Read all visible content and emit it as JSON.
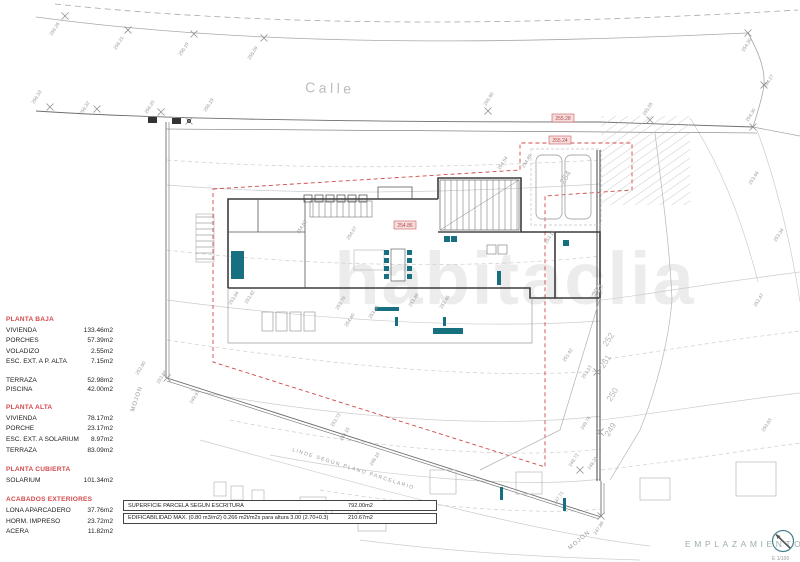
{
  "street": {
    "name": "Calle"
  },
  "watermark": {
    "text": "habitaclia"
  },
  "surface_schedule": {
    "sections": [
      {
        "title": "PLANTA BAJA",
        "compact": false,
        "rows": [
          {
            "label": "VIVIENDA",
            "value": "133.46m2"
          },
          {
            "label": "PORCHES",
            "value": "57.39m2"
          },
          {
            "label": "VOLADIZO",
            "value": "2.55m2"
          },
          {
            "label": "ESC. EXT. A P. ALTA",
            "value": "7.15m2"
          }
        ]
      },
      {
        "title": "",
        "compact": true,
        "rows": [
          {
            "label": "TERRAZA",
            "value": "52.98m2"
          },
          {
            "label": "PISCINA",
            "value": "42.00m2"
          }
        ]
      },
      {
        "title": "PLANTA ALTA",
        "compact": false,
        "rows": [
          {
            "label": "VIVIENDA",
            "value": "78.17m2"
          },
          {
            "label": "PORCHE",
            "value": "23.17m2"
          },
          {
            "label": "ESC. EXT. A SOLARIUM",
            "value": "8.97m2"
          },
          {
            "label": "TERRAZA",
            "value": "83.09m2"
          }
        ]
      },
      {
        "title": "PLANTA CUBIERTA",
        "compact": false,
        "rows": [
          {
            "label": "SOLARIUM",
            "value": "101.34m2"
          }
        ]
      },
      {
        "title": "ACABADOS EXTERIORES",
        "compact": false,
        "rows": [
          {
            "label": "LONA APARCADERO",
            "value": "37.76m2"
          },
          {
            "label": "HORM. IMPRESO",
            "value": "23.72m2"
          },
          {
            "label": "ACERA",
            "value": "11.82m2"
          }
        ]
      }
    ]
  },
  "summary_table": {
    "rows": [
      {
        "label": "SUPERFICIE PARCELA SEGÚN  ESCRITURA",
        "value": "792.00m2"
      },
      {
        "label": "EDIFICABILIDAD MÁX. (0.80 m3/m2)   0.266 m2t/m2s para altura 3.00 (2.70+0.3)",
        "value": "210.67m2"
      }
    ]
  },
  "title_block": {
    "title": "EMPLAZAMIENTO",
    "scale": "E 1/100",
    "icon": "compass-icon"
  },
  "boundary": {
    "linde_label": "LINDE SEGÚN PLANO PARCELARIO",
    "mojon_label_left": "MOJON",
    "mojon_label_right": "MOJON"
  },
  "levels": {
    "red_boxed": [
      [
        "255.28",
        552,
        114
      ],
      [
        "255.24",
        549,
        136
      ],
      [
        "254.86",
        394,
        221
      ]
    ],
    "spot": [
      [
        "256.26",
        52,
        36
      ],
      [
        "256.21",
        116,
        50
      ],
      [
        "256.19",
        181,
        56
      ],
      [
        "256.09",
        250,
        60
      ],
      [
        "254.30",
        744,
        52
      ],
      [
        "254.27",
        766,
        88
      ],
      [
        "256.33",
        34,
        104
      ],
      [
        "256.32",
        82,
        115
      ],
      [
        "256.20",
        147,
        114
      ],
      [
        "256.19",
        206,
        112
      ],
      [
        "255.90",
        486,
        106
      ],
      [
        "255.05",
        645,
        116
      ],
      [
        "254.30",
        748,
        122
      ],
      [
        "254.54",
        500,
        170
      ],
      [
        "254.49",
        524,
        168
      ],
      [
        "254.62",
        299,
        234
      ],
      [
        "254.07",
        349,
        240
      ],
      [
        "254.40",
        347,
        327
      ],
      [
        "253.84",
        231,
        305
      ],
      [
        "253.42",
        247,
        304
      ],
      [
        "253.79",
        338,
        310
      ],
      [
        "253.66",
        371,
        319
      ],
      [
        "253.49",
        411,
        307
      ],
      [
        "253.45",
        442,
        309
      ],
      [
        "253.73",
        333,
        427
      ],
      [
        "253.16",
        547,
        244
      ],
      [
        "253.08",
        159,
        384
      ],
      [
        "252.60",
        138,
        375
      ],
      [
        "249.97",
        192,
        404
      ],
      [
        "248.15",
        342,
        441
      ],
      [
        "248.18",
        372,
        466
      ],
      [
        "247.71",
        556,
        505
      ],
      [
        "247.88",
        596,
        535
      ],
      [
        "251.42",
        565,
        362
      ],
      [
        "251.13",
        584,
        379
      ],
      [
        "249.76",
        583,
        430
      ],
      [
        "248.72",
        571,
        467
      ],
      [
        "248.31",
        590,
        470
      ],
      [
        "253.44",
        751,
        185
      ],
      [
        "253.34",
        776,
        242
      ],
      [
        "252.47",
        756,
        307
      ],
      [
        "250.63",
        764,
        432
      ]
    ],
    "contours": [
      [
        "254",
        564,
        185
      ],
      [
        "253",
        596,
        298
      ],
      [
        "252",
        607,
        347
      ],
      [
        "251",
        604,
        369
      ],
      [
        "250",
        611,
        402
      ],
      [
        "249",
        609,
        437
      ]
    ]
  },
  "markers": {
    "x_points": [
      [
        65,
        16
      ],
      [
        128,
        30
      ],
      [
        194,
        34
      ],
      [
        264,
        38
      ],
      [
        748,
        33
      ],
      [
        764,
        85
      ],
      [
        50,
        107
      ],
      [
        97,
        109
      ],
      [
        161,
        112
      ],
      [
        189,
        121
      ],
      [
        488,
        111
      ],
      [
        650,
        120
      ],
      [
        753,
        127
      ],
      [
        167,
        378
      ],
      [
        601,
        516
      ],
      [
        597,
        372
      ],
      [
        600,
        432
      ],
      [
        580,
        470
      ]
    ]
  },
  "colors": {
    "red": "#d4494d",
    "teal": "#16707f",
    "contour_gray": "#c9c9c9",
    "label_gray": "#9a9a9a",
    "wall_ink": "#3c3c3c"
  }
}
